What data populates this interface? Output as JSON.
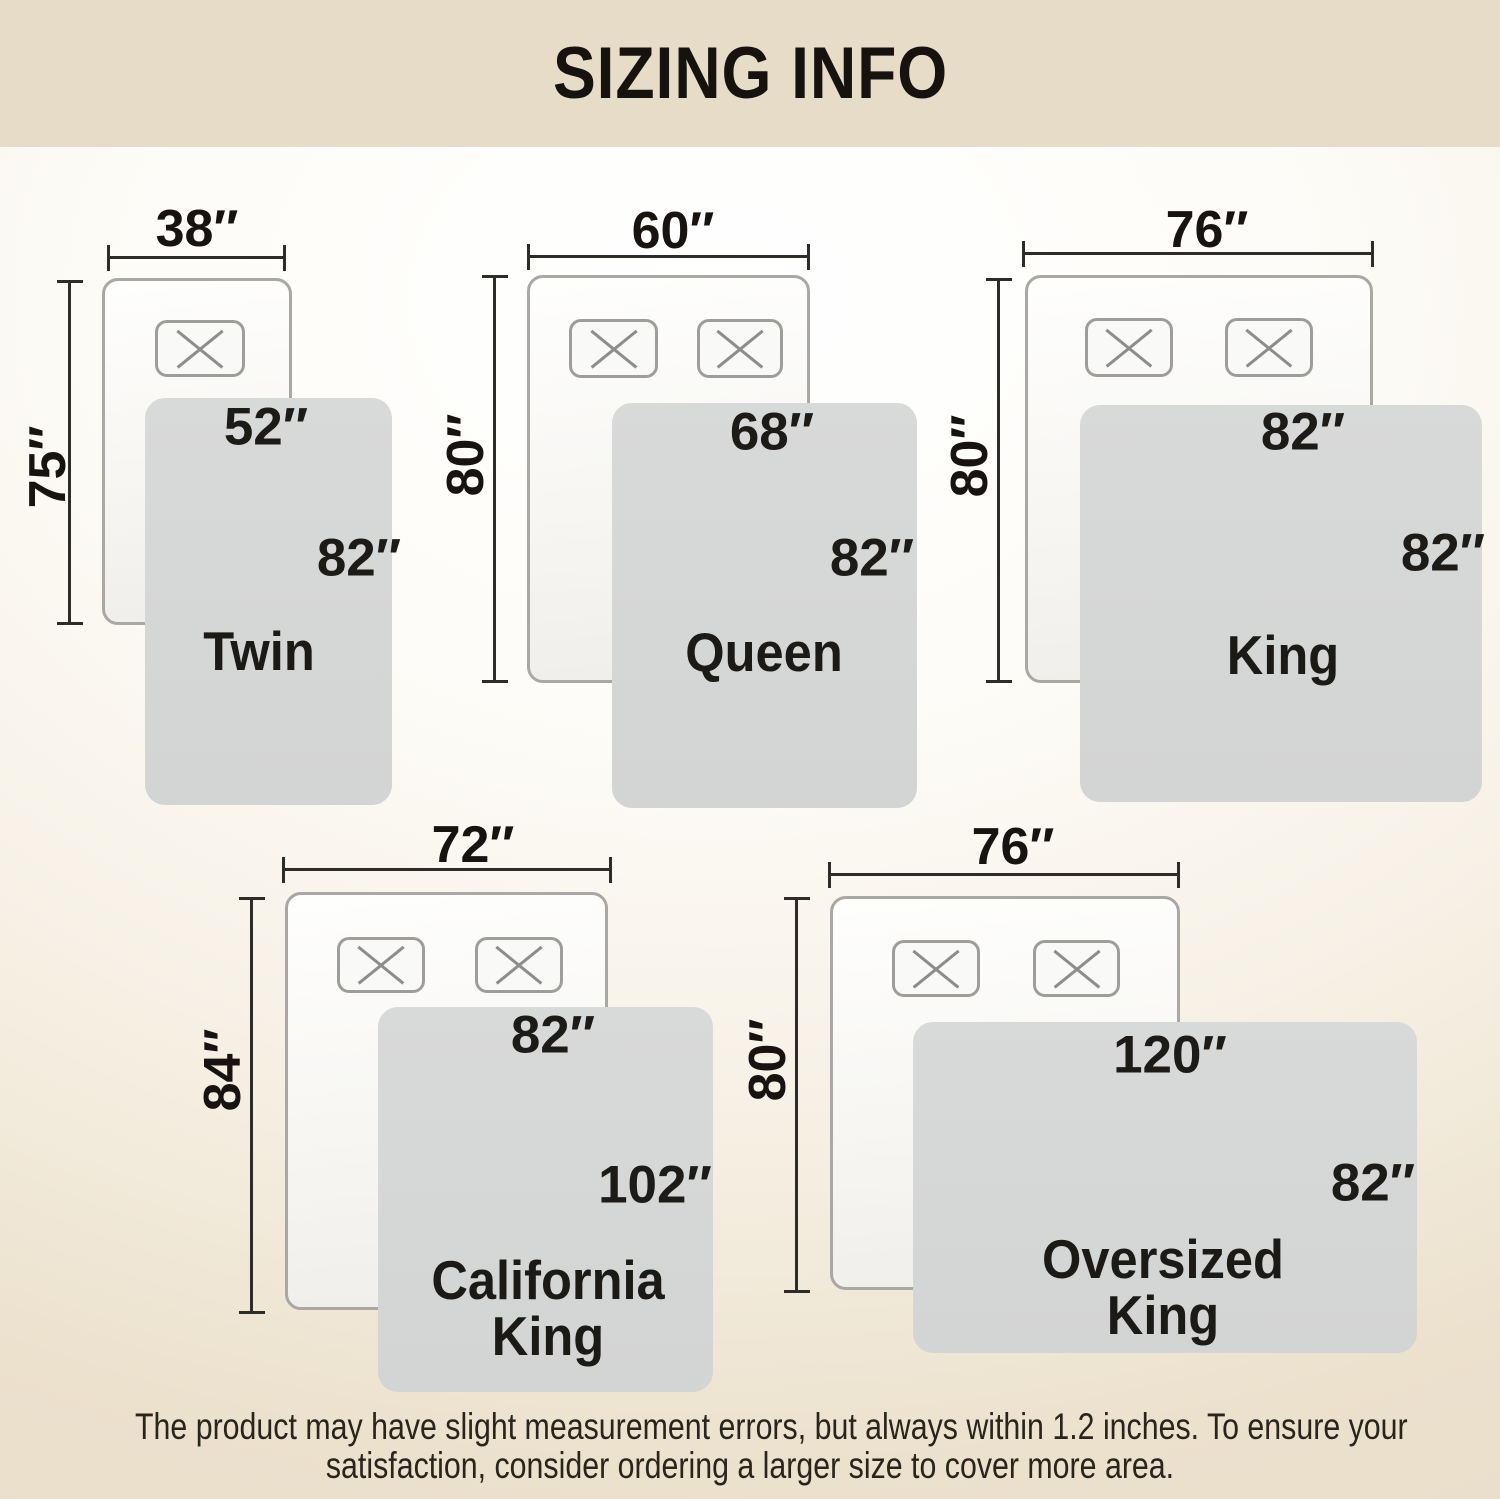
{
  "title": "SIZING INFO",
  "footer": {
    "line1": "The product may have slight measurement errors, but always within 1.2 inches. To ensure your",
    "line2": "satisfaction, consider ordering a larger size to cover more area."
  },
  "sizes": [
    {
      "id": "twin",
      "name": "Twin",
      "name_lines": [
        "Twin"
      ],
      "bed_width_label": "38″",
      "bed_length_label": "75″",
      "blanket_width_label": "52″",
      "blanket_length_label": "82″",
      "pillow_count": 1
    },
    {
      "id": "queen",
      "name": "Queen",
      "name_lines": [
        "Queen"
      ],
      "bed_width_label": "60″",
      "bed_length_label": "80″",
      "blanket_width_label": "68″",
      "blanket_length_label": "82″",
      "pillow_count": 2
    },
    {
      "id": "king",
      "name": "King",
      "name_lines": [
        "King"
      ],
      "bed_width_label": "76″",
      "bed_length_label": "80″",
      "blanket_width_label": "82″",
      "blanket_length_label": "82″",
      "pillow_count": 2
    },
    {
      "id": "california-king",
      "name": "California King",
      "name_lines": [
        "California",
        "King"
      ],
      "bed_width_label": "72″",
      "bed_length_label": "84″",
      "blanket_width_label": "82″",
      "blanket_length_label": "102″",
      "pillow_count": 2
    },
    {
      "id": "oversized-king",
      "name": "Oversized King",
      "name_lines": [
        "Oversized",
        "King"
      ],
      "bed_width_label": "76″",
      "bed_length_label": "80″",
      "blanket_width_label": "120″",
      "blanket_length_label": "82″",
      "pillow_count": 2
    }
  ],
  "colors": {
    "header_bg": "#e6dcc8",
    "page_bottom": "#e8decb",
    "blanket_gray": "#d6d7d7",
    "bed_border": "#a9a8a5",
    "dimension_line": "#2e2c29",
    "text_dark": "#1c1a17"
  }
}
